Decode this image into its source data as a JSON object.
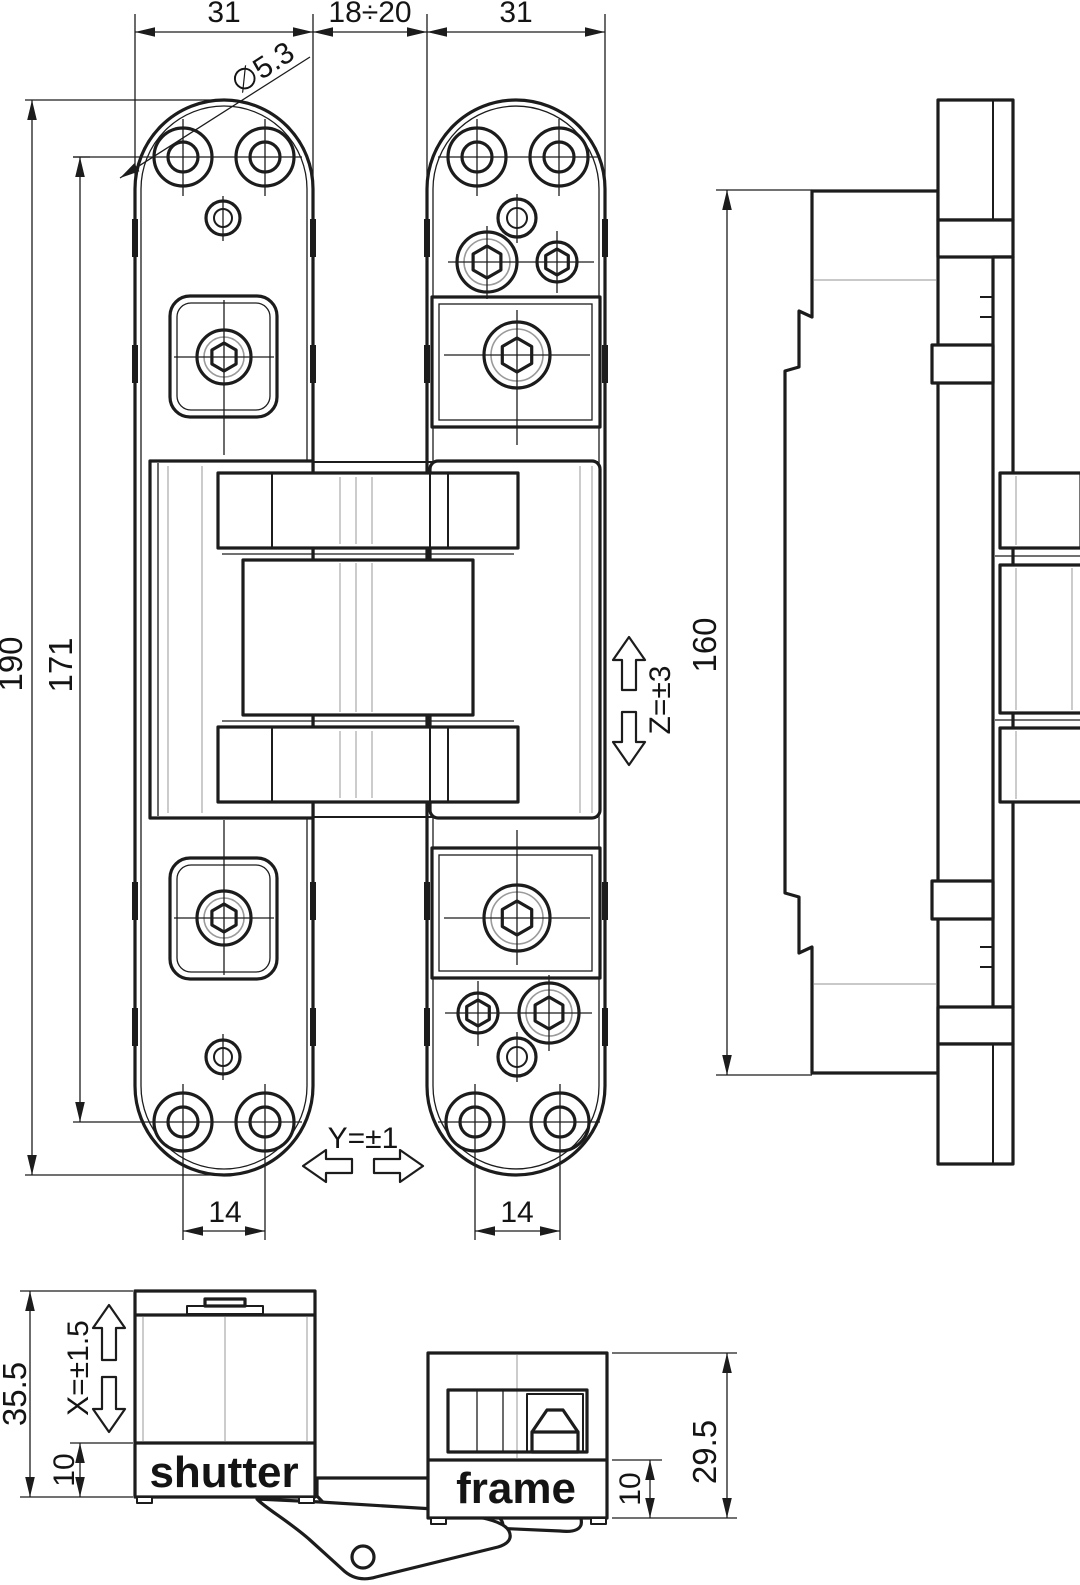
{
  "meta": {
    "drawing_type": "technical drawing",
    "subject": "concealed invisible door hinge - dimensioned views"
  },
  "colors": {
    "line": "#1c1c1c",
    "faint": "#a9a9a9",
    "background": "#ffffff"
  },
  "front_view": {
    "dim_plate_width_left": "31",
    "dim_gap": "18÷20",
    "dim_plate_width_right": "31",
    "dim_screw_hole_dia": "∅5.3",
    "dim_total_height": "190",
    "dim_hole_span": "171",
    "dim_screw_span_left": "14",
    "dim_screw_span_right": "14",
    "adjust_horizontal": "Y=±1",
    "adjust_vertical": "Z=±3"
  },
  "side_view": {
    "dim_body_height": "160"
  },
  "section_view": {
    "label_door_leaf": "shutter",
    "label_door_frame": "frame",
    "dim_shutter_depth": "35.5",
    "dim_shutter_plate_height": "10",
    "adjust_depth": "X=±1.5",
    "dim_frame_depth": "29.5",
    "dim_frame_plate_height": "10"
  }
}
